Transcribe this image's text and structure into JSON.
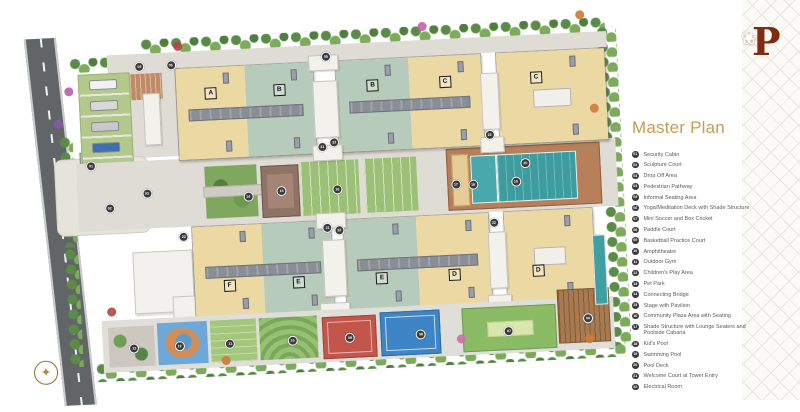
{
  "brand": {
    "monogram": "P",
    "flower_icon": "❀"
  },
  "legend": {
    "title": "Master Plan",
    "title_color": "#C69C52",
    "items": [
      {
        "num": "01",
        "label": "Security Cabin"
      },
      {
        "num": "02",
        "label": "Sculpture Court"
      },
      {
        "num": "03",
        "label": "Drop Off Area"
      },
      {
        "num": "04",
        "label": "Pedestrian Pathway"
      },
      {
        "num": "05",
        "label": "Informal Seating Area"
      },
      {
        "num": "06",
        "label": "Yoga/Meditation Deck with Shade Structure"
      },
      {
        "num": "07",
        "label": "Mini Soccer and Box Cricket"
      },
      {
        "num": "08",
        "label": "Paddle Court"
      },
      {
        "num": "09",
        "label": "Basketball Practice Court"
      },
      {
        "num": "10",
        "label": "Amphitheatre"
      },
      {
        "num": "11",
        "label": "Outdoor Gym"
      },
      {
        "num": "12",
        "label": "Children's Play Area"
      },
      {
        "num": "13",
        "label": "Pet Park"
      },
      {
        "num": "14",
        "label": "Connecting Bridge"
      },
      {
        "num": "15",
        "label": "Stage with Pavilion"
      },
      {
        "num": "16",
        "label": "Community Plaza Area with Seating"
      },
      {
        "num": "17",
        "label": "Shade Structure with Lounge Seaters and Poolside Cabana"
      },
      {
        "num": "18",
        "label": "Kid's Pool"
      },
      {
        "num": "19",
        "label": "Swimming Pool"
      },
      {
        "num": "20",
        "label": "Pool Deck"
      },
      {
        "num": "21",
        "label": "Welcome Court at Tower Entry"
      },
      {
        "num": "22",
        "label": "Electrical Room"
      }
    ]
  },
  "plan": {
    "entry_label": "ENTRY ▸",
    "exit_label": "EXIT ◂",
    "blocks": [
      {
        "left": "A",
        "right": "B"
      },
      {
        "left": "B",
        "right": "C"
      },
      {
        "single": "C"
      },
      {
        "left": "F",
        "right": "E"
      },
      {
        "left": "E",
        "right": "D"
      },
      {
        "single": "D"
      }
    ],
    "colors": {
      "tan_roof": "#ECD8A2",
      "sage_roof": "#B6CBBA",
      "pool_teal": "#3D9CA0",
      "deck_brown": "#B5805A",
      "court_red": "#C2564A",
      "court_blue": "#3D85C4",
      "field_green": "#8CBB66",
      "road_gray": "#616568",
      "legend_gold": "#C69C52"
    },
    "markers": [
      {
        "n": "01",
        "x": 12.1,
        "y": 37.9
      },
      {
        "n": "02",
        "x": 14.8,
        "y": 49.0
      },
      {
        "n": "03",
        "x": 21.0,
        "y": 45.6
      },
      {
        "n": "04",
        "x": 20.8,
        "y": 13.3
      },
      {
        "n": "05",
        "x": 25.9,
        "y": 13.3
      },
      {
        "n": "05",
        "x": 51.3,
        "y": 13.1
      },
      {
        "n": "06",
        "x": 92.0,
        "y": 82.8
      },
      {
        "n": "07",
        "x": 79.0,
        "y": 85.1
      },
      {
        "n": "08",
        "x": 64.6,
        "y": 84.9
      },
      {
        "n": "09",
        "x": 53.0,
        "y": 84.9
      },
      {
        "n": "10",
        "x": 43.6,
        "y": 84.9
      },
      {
        "n": "11",
        "x": 33.4,
        "y": 84.9
      },
      {
        "n": "12",
        "x": 25.1,
        "y": 84.9
      },
      {
        "n": "13",
        "x": 17.7,
        "y": 84.9
      },
      {
        "n": "14",
        "x": 37.5,
        "y": 47.7
      },
      {
        "n": "15",
        "x": 43.0,
        "y": 46.7
      },
      {
        "n": "16",
        "x": 52.1,
        "y": 46.9
      },
      {
        "n": "17",
        "x": 71.5,
        "y": 47.2
      },
      {
        "n": "18",
        "x": 74.3,
        "y": 47.4
      },
      {
        "n": "19",
        "x": 81.3,
        "y": 47.2
      },
      {
        "n": "20",
        "x": 83.0,
        "y": 42.6
      },
      {
        "n": "21",
        "x": 50.0,
        "y": 35.9
      },
      {
        "n": "22",
        "x": 52.0,
        "y": 34.9
      },
      {
        "n": "22",
        "x": 77.4,
        "y": 34.9
      },
      {
        "n": "21",
        "x": 50.2,
        "y": 56.7
      },
      {
        "n": "22",
        "x": 52.1,
        "y": 57.4
      },
      {
        "n": "22",
        "x": 77.4,
        "y": 57.4
      },
      {
        "n": "22",
        "x": 26.7,
        "y": 57.2
      }
    ]
  }
}
